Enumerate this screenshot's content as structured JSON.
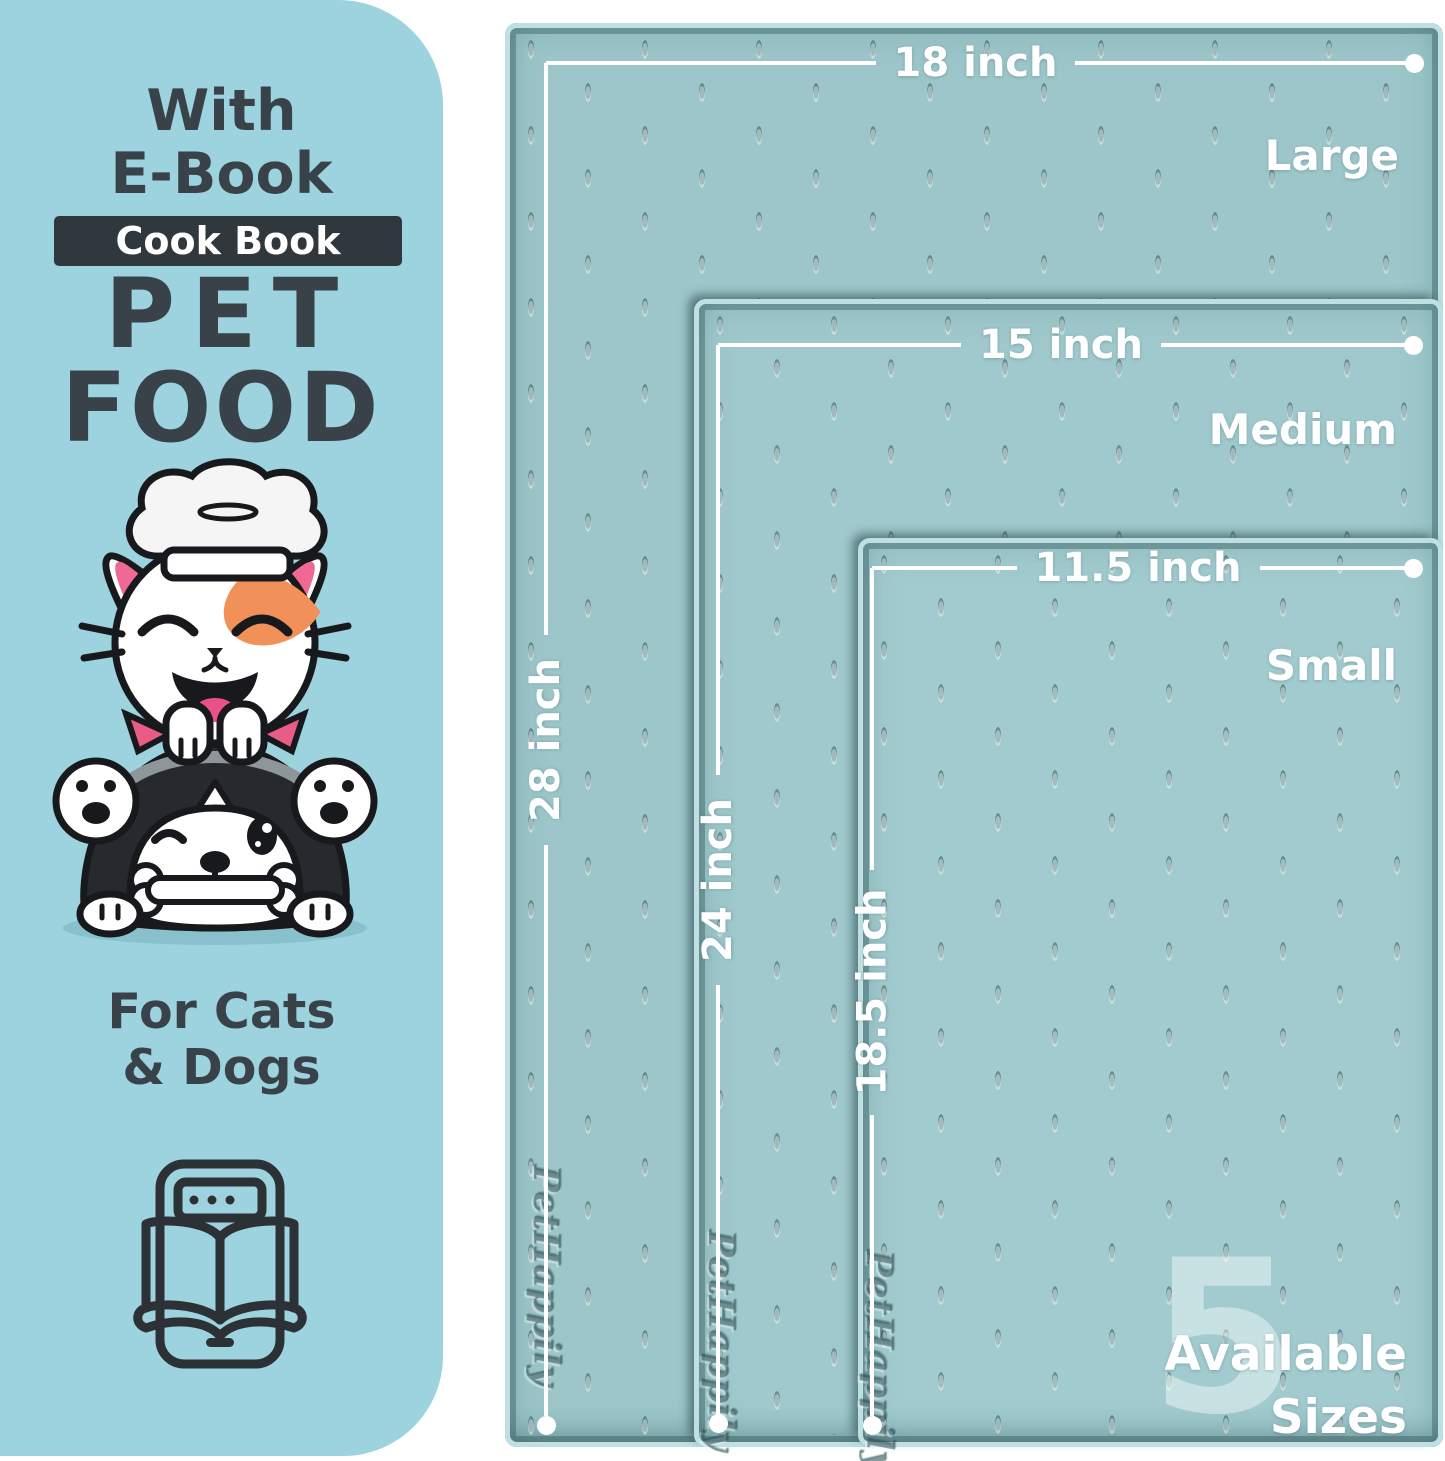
{
  "colors": {
    "panel_bg": "#9cd3df",
    "panel_text": "#394248",
    "badge_bg": "#31383d",
    "mat_surface_large": "#9cc6c9",
    "mat_surface_medium": "#9fc9cc",
    "mat_surface_small": "#a1cbce",
    "mat_edge_highlight": "#bfe0e2",
    "mat_groove": "#2b5258",
    "dimension_line": "#ffffff",
    "watermark": "rgba(255,255,255,0.42)",
    "cat_patch_orange": "#f19159",
    "pink_accent": "#ea5186",
    "outline_dark": "#17191c"
  },
  "left_panel": {
    "heading_line1": "With",
    "heading_line2": "E-Book",
    "badge_label": "Cook Book",
    "title_line1": "PET",
    "title_line2": "FOOD",
    "subtitle_line1": "For Cats",
    "subtitle_line2": "& Dogs",
    "illustration_alt": "cat chef on husky dog holding bone",
    "icon_alt": "e-book open on tablet"
  },
  "mats": [
    {
      "size_label": "Large",
      "width_label": "18 inch",
      "height_label": "28 inch",
      "brand_emboss": "PetHappily"
    },
    {
      "size_label": "Medium",
      "width_label": "15 inch",
      "height_label": "24 inch",
      "brand_emboss": "PetHappily"
    },
    {
      "size_label": "Small",
      "width_label": "11.5 inch",
      "height_label": "18.5 inch",
      "brand_emboss": "PetHappily"
    }
  ],
  "availability": {
    "count": "5",
    "line1": "Available",
    "line2": "Sizes"
  }
}
